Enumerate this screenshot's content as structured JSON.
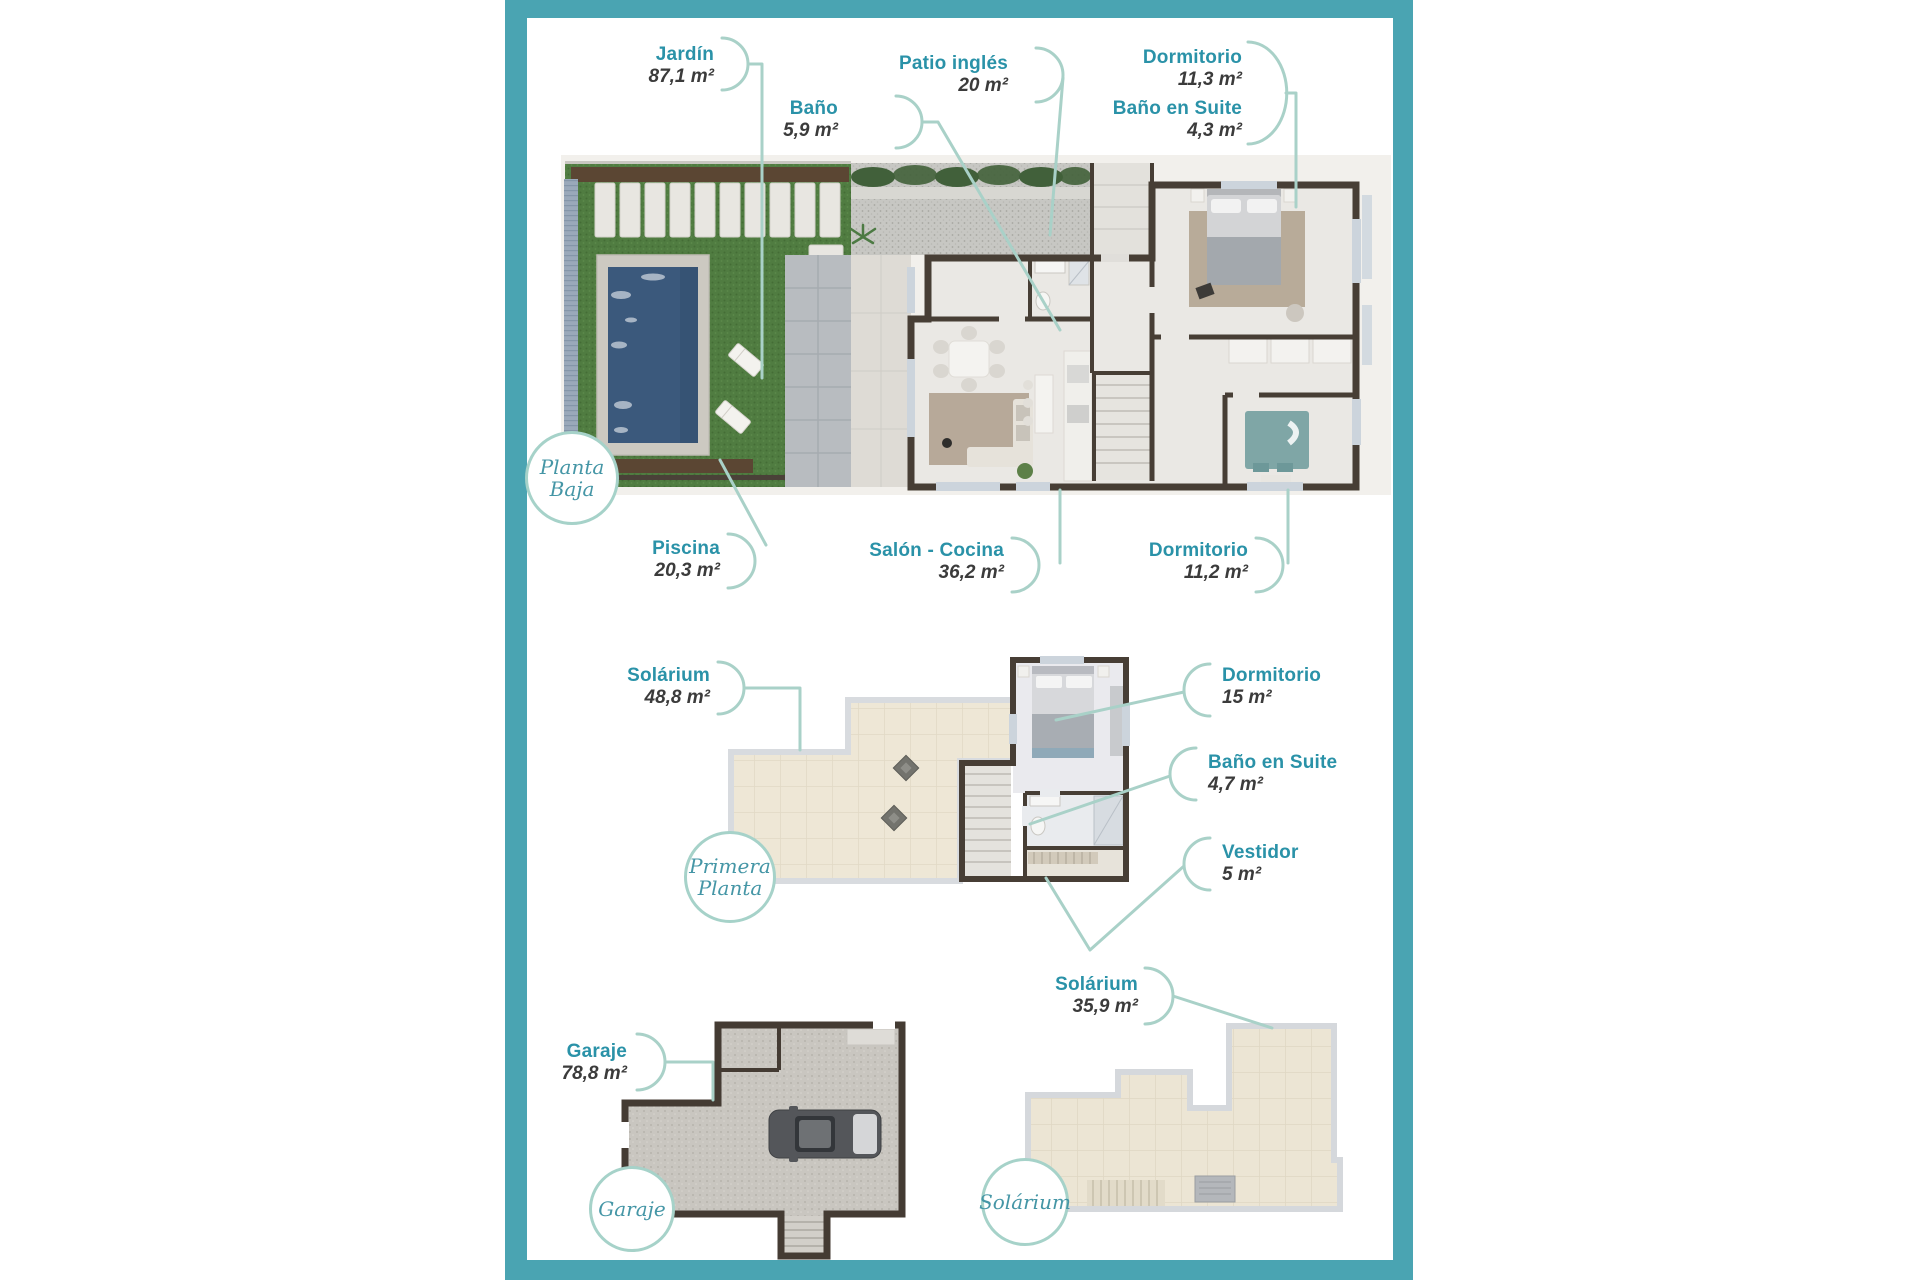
{
  "palette": {
    "frame": "#4aa4b2",
    "label_text": "#2a92a8",
    "area_text": "#3b3b3b",
    "callout_line": "#a9d1c8",
    "badge_border": "#a6d2c9",
    "badge_text": "#4596a6"
  },
  "floors": [
    {
      "id": "planta-baja",
      "badge_lines": [
        "Planta",
        "Baja"
      ],
      "labels": [
        {
          "id": "jardin",
          "name": "Jardín",
          "area": "87,1 m²"
        },
        {
          "id": "bano",
          "name": "Baño",
          "area": "5,9 m²"
        },
        {
          "id": "patio-ingles",
          "name": "Patio inglés",
          "area": "20 m²"
        },
        {
          "id": "dormitorio-principal",
          "name": "Dormitorio",
          "area": "11,3 m²"
        },
        {
          "id": "bano-en-suite",
          "name": "Baño en Suite",
          "area": "4,3 m²"
        },
        {
          "id": "piscina",
          "name": "Piscina",
          "area": "20,3 m²"
        },
        {
          "id": "salon-cocina",
          "name": "Salón - Cocina",
          "area": "36,2 m²"
        },
        {
          "id": "dormitorio-2",
          "name": "Dormitorio",
          "area": "11,2 m²"
        }
      ]
    },
    {
      "id": "primera-planta",
      "badge_lines": [
        "Primera",
        "Planta"
      ],
      "labels": [
        {
          "id": "solarium",
          "name": "Solárium",
          "area": "48,8 m²"
        },
        {
          "id": "dormitorio",
          "name": "Dormitorio",
          "area": "15 m²"
        },
        {
          "id": "bano-en-suite",
          "name": "Baño en Suite",
          "area": "4,7 m²"
        },
        {
          "id": "vestidor",
          "name": "Vestidor",
          "area": "5 m²"
        }
      ]
    },
    {
      "id": "garaje",
      "badge_lines": [
        "Garaje"
      ],
      "labels": [
        {
          "id": "garaje",
          "name": "Garaje",
          "area": "78,8 m²"
        }
      ]
    },
    {
      "id": "solarium",
      "badge_lines": [
        "Solárium"
      ],
      "labels": [
        {
          "id": "solarium",
          "name": "Solárium",
          "area": "35,9 m²"
        }
      ]
    }
  ]
}
